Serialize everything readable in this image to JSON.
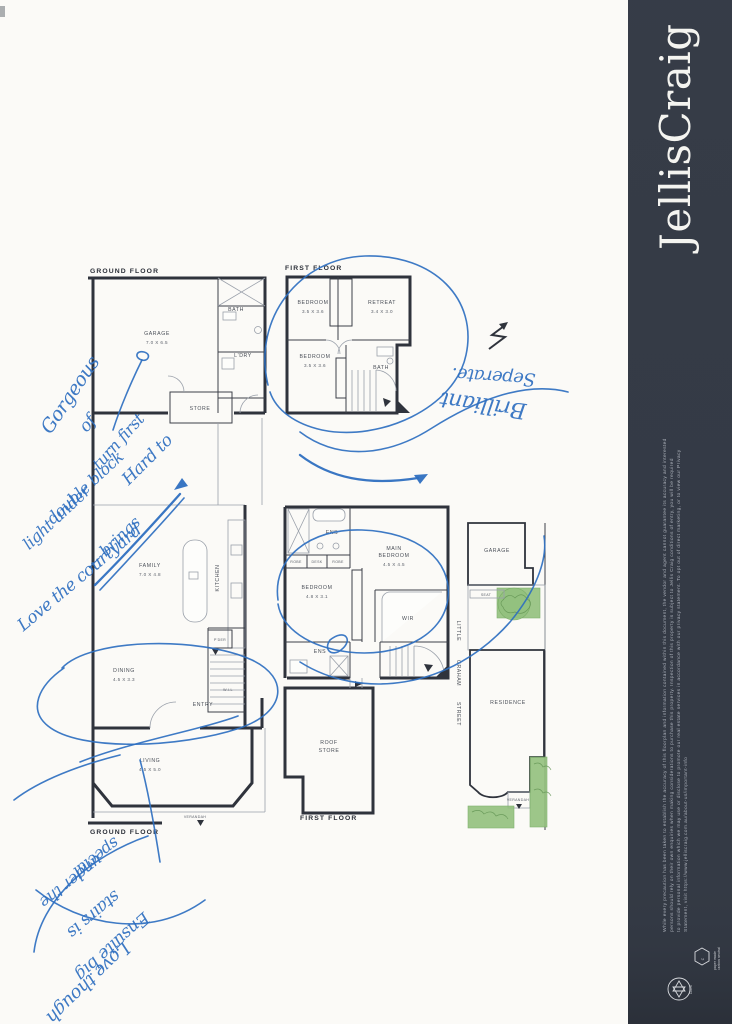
{
  "document": {
    "type": "scanned floorplan page",
    "page_color": "#fbfaf7"
  },
  "brand": {
    "name": "JellisCraig",
    "sidebar_color": "#343a45",
    "disclaimer": {
      "line1": "While every precaution has been taken to establish the accuracy of this floorplan and information contained within this document, the vendor and agent cannot guarantee its accuracy and interested",
      "line2": "persons should rely on their own enquiries when making considerations to purchase this property. Inspection of this property is subject to Jellis Craig conditions of entry, you will be required",
      "line3": "to provide personal information which we may use or disclose to promote our real estate services in accordance with our privacy statement. To opt out of direct marketing, or to view our Privacy",
      "line4": "Statement, visit https://www.jelliscraig.com.au/about-us/important-info"
    },
    "badges": {
      "carbon_glyph": "C",
      "carbon_line1": "paper made",
      "carbon_line2": "carbon neutral",
      "recycled": "100%"
    }
  },
  "ground_floor": {
    "title": "GROUND FLOOR",
    "footer": "GROUND FLOOR",
    "garage": "GARAGE",
    "garage_dims": "7.0 X 6.5",
    "bath": "BATH",
    "ldry": "L'DRY",
    "store": "STORE",
    "family": "FAMILY",
    "family_dims": "7.0 X 4.8",
    "kitchen": "KITCHEN",
    "pdr": "P'DER",
    "dining": "DINING",
    "dining_dims": "4.5 X 3.3",
    "entry": "ENTRY",
    "wil": "W.I.L",
    "living": "LIVING",
    "living_dims": "4.5 X 5.0",
    "verandah": "VERANDAH"
  },
  "first_floor_upper": {
    "title": "FIRST FLOOR",
    "bedroom1": "BEDROOM",
    "bedroom1_dims": "3.5 X 3.6",
    "retreat": "RETREAT",
    "retreat_dims": "3.4 X 3.0",
    "bedroom2": "BEDROOM",
    "bedroom2_dims": "3.5 X 3.6",
    "bath": "BATH"
  },
  "first_floor_lower": {
    "footer": "FIRST FLOOR",
    "ens1": "ENS",
    "main_bedroom": "MAIN",
    "main_bedroom2": "BEDROOM",
    "main_bedroom_dims": "4.5 X 4.5",
    "robe1": "ROBE",
    "desk": "DESK",
    "robe2": "ROBE",
    "bedroom": "BEDROOM",
    "bedroom_dims": "4.8 X 3.1",
    "wir": "WIR",
    "ens2": "ENS",
    "roof_store1": "ROOF",
    "roof_store2": "STORE"
  },
  "site_plan": {
    "garage": "GARAGE",
    "seat": "SEAT",
    "residence": "RESIDENCE",
    "verandah": "VERANDAH",
    "street_word1": "LITTLE",
    "street_word2": "GRAHAM",
    "street_word3": "STREET"
  },
  "handwriting": {
    "ink_color": "#2e6fc0",
    "left_note": {
      "l1": "Gorgeous",
      "l2": "of",
      "l3": "turn first",
      "l4": "Hard to",
      "l5": "double block",
      "l6": "light under",
      "l7": "— brings",
      "l8": "Love the courtyard"
    },
    "right_note": {
      "l1": "Seperate.",
      "l2": "Brilliant"
    },
    "bottom_note": {
      "l1": "special",
      "l2": "under the",
      "l3": "stairs is",
      "l4": "Ensuite big",
      "l5": "Love though"
    }
  }
}
